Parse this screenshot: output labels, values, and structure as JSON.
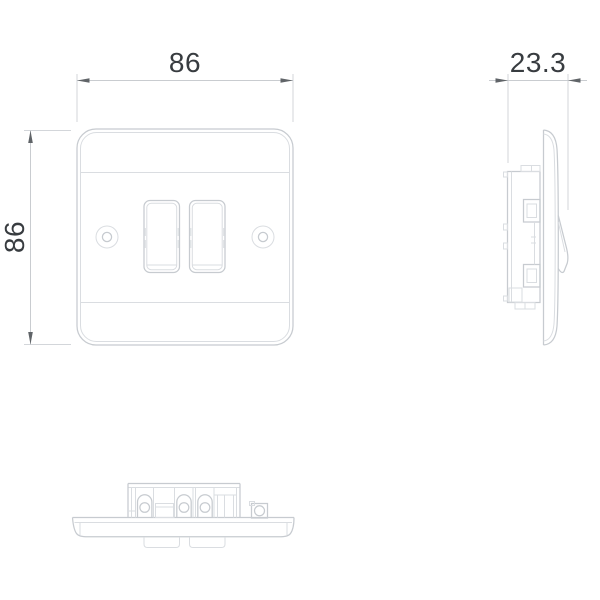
{
  "colors": {
    "background": "#ffffff",
    "drawing_line": "#c7cbd0",
    "drawing_line_light": "#dadde1",
    "dimension_line": "#c9ccd0",
    "arrow": "#606468",
    "dimension_text": "#383c40"
  },
  "dimensions": {
    "width": {
      "value": "86"
    },
    "height": {
      "value": "86"
    },
    "depth": {
      "value": "23.3"
    }
  }
}
